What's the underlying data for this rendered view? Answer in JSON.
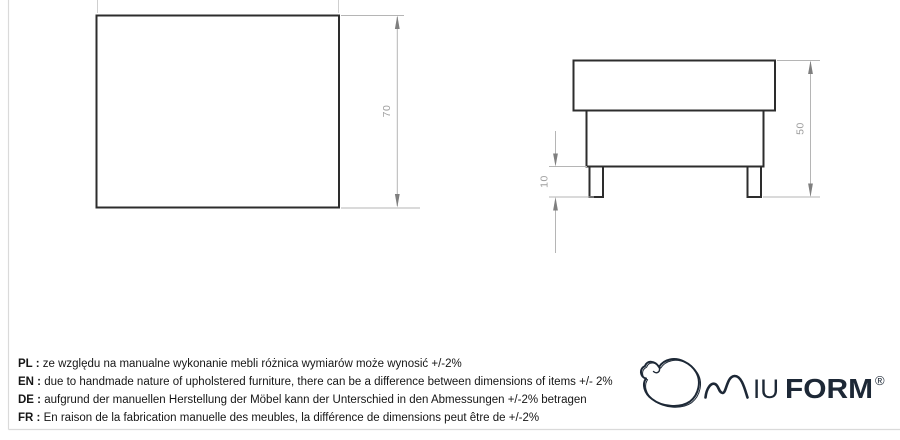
{
  "dimensions": {
    "top_view": {
      "height": "70"
    },
    "side_view": {
      "total_height": "50",
      "leg_height": "10"
    }
  },
  "disclaimer": {
    "separator": " : ",
    "lines": [
      {
        "lang": "PL",
        "text": "ze względu na manualne wykonanie mebli różnica wymiarów może wynosić +/-2%"
      },
      {
        "lang": "EN",
        "text": "due to handmade nature of upholstered furniture, there can be a difference between dimensions of items +/- 2%"
      },
      {
        "lang": "DE",
        "text": "aufgrund der manuellen Herstellung der Möbel kann der Unterschied in den Abmessungen +/-2% betragen"
      },
      {
        "lang": "FR",
        "text": "En raison de la fabrication manuelle des meubles, la différence de dimensions peut être de +/-2%"
      }
    ]
  },
  "logo": {
    "brand": "MIUFORM",
    "letters_iu": "IU",
    "letters_form": "FORM",
    "registered": "®"
  },
  "colors": {
    "outline": "#2d2d2d",
    "dimension_line": "#b5b5b5",
    "dimension_arrow": "#7f7f7f",
    "dimension_text": "#9e9e9e",
    "body_text": "#161616",
    "frame_line": "#dadada",
    "logo": "#1d2836"
  }
}
